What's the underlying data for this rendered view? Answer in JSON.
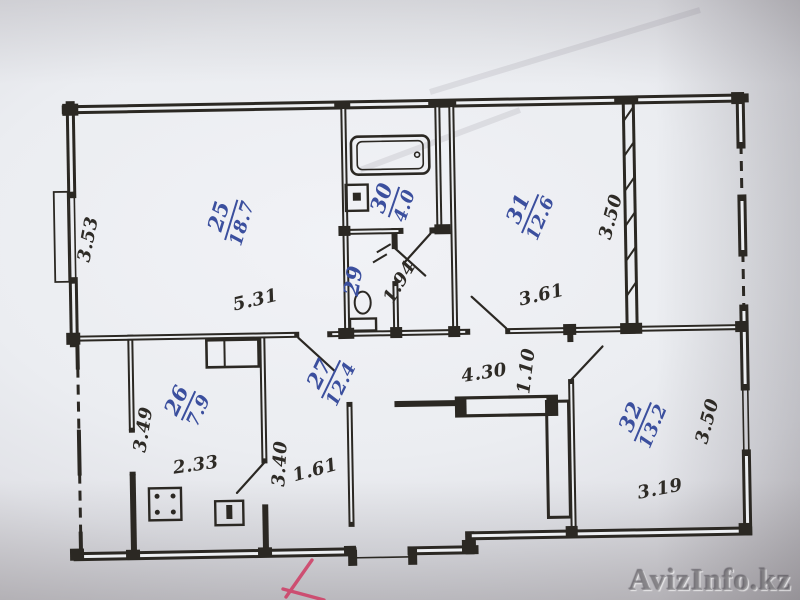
{
  "watermark": "AvizInfo.kz",
  "colors": {
    "ink_blue": "#3b4f9e",
    "ink_black": "#2e2b26",
    "red_mark": "#cf3b63"
  },
  "rooms": {
    "r25": {
      "number": "25",
      "area": "18.7"
    },
    "r26": {
      "number": "26",
      "area": "7.9"
    },
    "r27": {
      "number": "27",
      "area": "12.4"
    },
    "r29": {
      "number": "29"
    },
    "r30": {
      "number": "30",
      "area": "4.0"
    },
    "r31": {
      "number": "31",
      "area": "12.6"
    },
    "r32": {
      "number": "32",
      "area": "13.2"
    }
  },
  "dimensions": {
    "d353": "3.53",
    "d531": "5.31",
    "d361": "3.61",
    "d350a": "3.50",
    "d350b": "3.50",
    "d319": "3.19",
    "d430": "4.30",
    "d110": "1.10",
    "d194": "1.94",
    "d349": "3.49",
    "d233": "2.33",
    "d340": "3.40",
    "d161": "1.61"
  }
}
